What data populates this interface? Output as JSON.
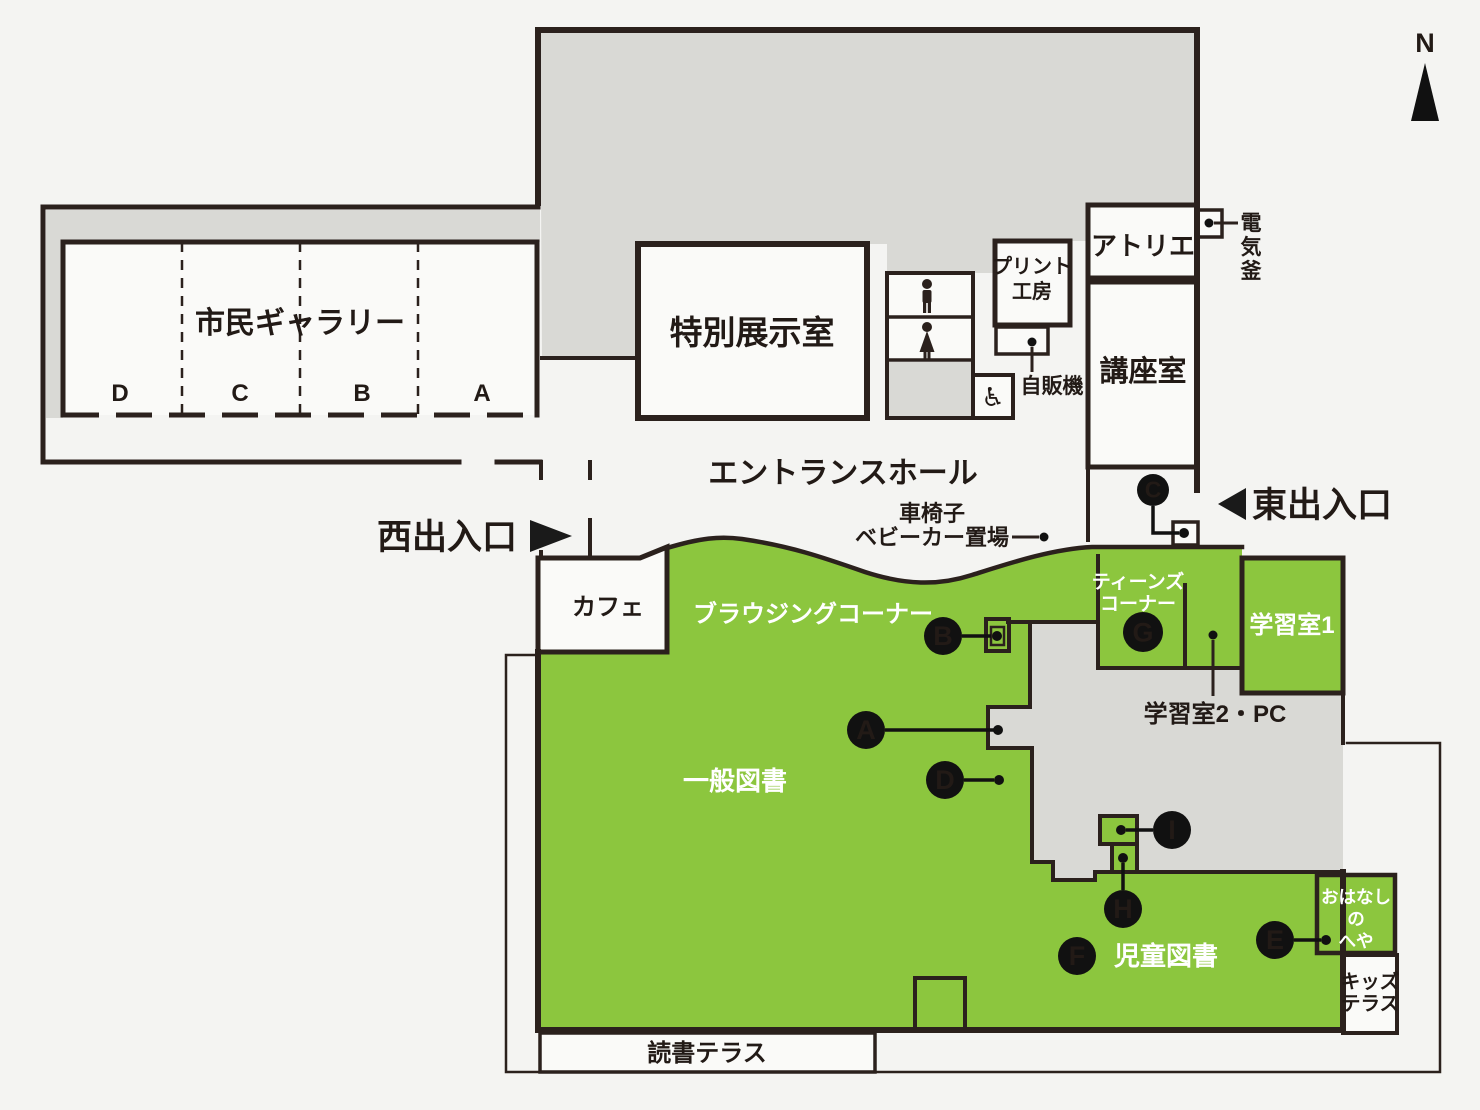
{
  "map_title": "library-floor-map",
  "colors": {
    "background": "#f4f4f2",
    "building_gray": "#d9d9d5",
    "zone_green": "#8cc63e",
    "wall_dark": "#2b211d",
    "room_white": "#fafaf8",
    "marker_black": "#111111"
  },
  "compass": {
    "label": "N"
  },
  "rooms": {
    "gallery": {
      "label": "市民ギャラリー",
      "sections": [
        "D",
        "C",
        "B",
        "A"
      ]
    },
    "special_exhibition": {
      "label": "特別展示室"
    },
    "print_studio": {
      "line1": "プリント",
      "line2": "工房"
    },
    "vending": {
      "label": "自販機"
    },
    "atelier": {
      "label": "アトリエ"
    },
    "kiln": {
      "chars": [
        "電",
        "気",
        "釜"
      ]
    },
    "lecture": {
      "label": "講座室"
    },
    "entrance_hall": {
      "label": "エントランスホール"
    },
    "wheel_storage": {
      "line1": "車椅子",
      "line2": "ベビーカー置場"
    },
    "west_entrance": {
      "label": "西出入口"
    },
    "east_entrance": {
      "label": "東出入口"
    },
    "cafe": {
      "label": "カフェ"
    },
    "browsing": {
      "label": "ブラウジングコーナー"
    },
    "general_books": {
      "label": "一般図書"
    },
    "teens": {
      "line1": "ティーンズ",
      "line2": "コーナー"
    },
    "study1": {
      "label": "学習室1"
    },
    "study2": {
      "label": "学習室2・PC"
    },
    "children_books": {
      "label": "児童図書"
    },
    "story_room": {
      "line1": "おはなし",
      "line2": "の",
      "line3": "へや"
    },
    "kids_terrace": {
      "line1": "キッズ",
      "line2": "テラス"
    },
    "reading_terrace": {
      "label": "読書テラス"
    },
    "wheelchair_symbol": "♿"
  },
  "markers": [
    {
      "letter": "A",
      "cx": 866,
      "cy": 730,
      "r": 19,
      "line": [
        885,
        730,
        994,
        730
      ],
      "dot": [
        998,
        730
      ]
    },
    {
      "letter": "B",
      "cx": 943,
      "cy": 636,
      "r": 19,
      "line": [
        962,
        636,
        991,
        636
      ],
      "dot": [
        997,
        636
      ]
    },
    {
      "letter": "C",
      "cx": 1153,
      "cy": 490,
      "r": 16,
      "poly": [
        [
          1153,
          506
        ],
        [
          1153,
          533
        ],
        [
          1179,
          533
        ]
      ],
      "dot": [
        1184,
        533
      ]
    },
    {
      "letter": "D",
      "cx": 945,
      "cy": 780,
      "r": 19,
      "line": [
        964,
        780,
        994,
        780
      ],
      "dot": [
        999,
        780
      ]
    },
    {
      "letter": "E",
      "cx": 1275,
      "cy": 940,
      "r": 19,
      "line": [
        1294,
        940,
        1321,
        940
      ],
      "dot": [
        1326,
        940
      ]
    },
    {
      "letter": "F",
      "cx": 1077,
      "cy": 956,
      "r": 19
    },
    {
      "letter": "G",
      "cx": 1143,
      "cy": 632,
      "r": 20
    },
    {
      "letter": "H",
      "cx": 1123,
      "cy": 909,
      "r": 19,
      "line": [
        1123,
        890,
        1123,
        863
      ],
      "dot": [
        1123,
        858
      ]
    },
    {
      "letter": "I",
      "cx": 1172,
      "cy": 830,
      "r": 19,
      "line": [
        1153,
        830,
        1126,
        830
      ],
      "dot": [
        1121,
        830
      ]
    }
  ],
  "callouts": [
    {
      "name": "kiln-callout",
      "dot": [
        1209,
        223
      ],
      "line": [
        1214,
        223,
        1238,
        223
      ]
    },
    {
      "name": "vending-callout",
      "dot": [
        1032,
        342
      ],
      "line": [
        1032,
        347,
        1032,
        372
      ]
    },
    {
      "name": "wheel-storage-callout",
      "dot": [
        1044,
        537
      ],
      "line": [
        1012,
        537,
        1039,
        537
      ]
    },
    {
      "name": "study2-callout",
      "dot": [
        1213,
        635
      ],
      "line": [
        1213,
        640,
        1213,
        696
      ]
    }
  ]
}
